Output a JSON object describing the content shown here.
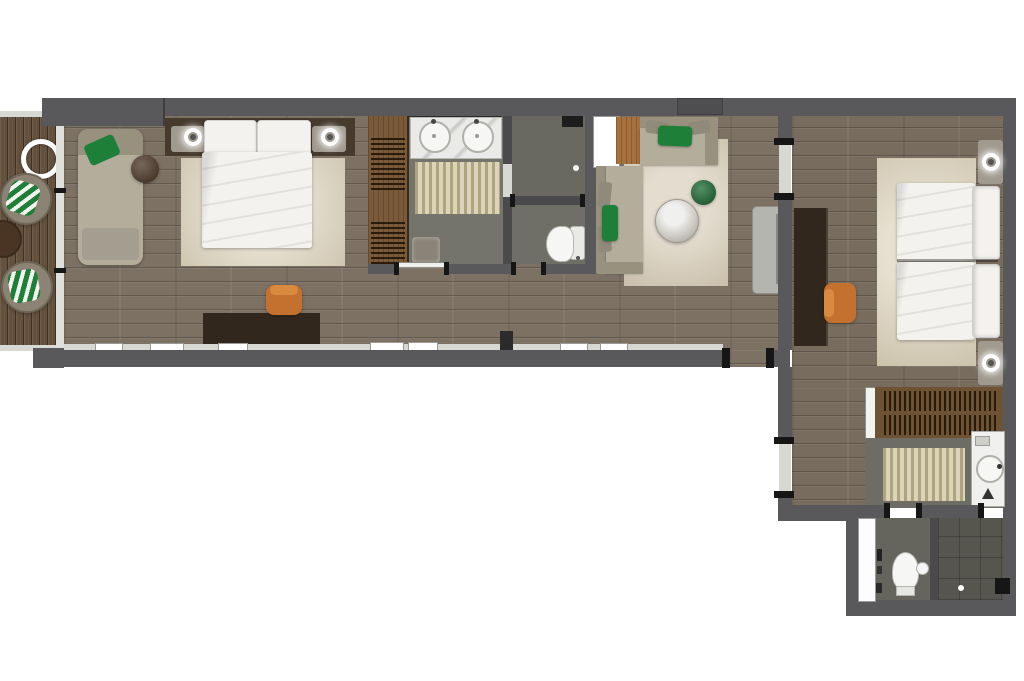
{
  "palette": {
    "wall": "#59595b",
    "wallInner": "#4a4a4c",
    "wallColumn": "#4e4e50",
    "window": "#e0e0da",
    "doorFill": "#d8d8d2",
    "jamb": "#161616",
    "woodMain": "#7d7164",
    "woodRight": "#786c5f",
    "deck": "#64513e",
    "tile": "#74746c",
    "tileShower": "#69695f",
    "tileWC": "#6f6f67",
    "tileBath2": "#6d6d65",
    "tileWC2": "#65655e",
    "tileShower2": "#56564f",
    "rugMaster": "#dcd2bc",
    "rugLiving": "#d5cab5",
    "rugBed2": "#d9cfb7",
    "bathMat": "#ccc29e",
    "bedWhite": "#f3f2ef",
    "sofa": "#b4ad9c",
    "sofaBack": "#98917e",
    "cushionGray": "#8f8a7a",
    "accentGreen": "#1e8038",
    "poufGreen": "#1a6a33",
    "desk": "#32271c",
    "drawer": "#15100b",
    "chairOrange": "#c4702e",
    "wardrobeWood": "#7a5a39",
    "closetWood": "#6d5233",
    "marble": "#eaeae8",
    "tableStone": "#c2bfb8",
    "console": "#b5b5b0",
    "nightstand": "#a09a8e",
    "headboard": "#463a2d",
    "cabinetWood": "#a6713c",
    "fixtureWhite": "#f6f6f4",
    "loungeChair": "#8d8374",
    "sideTableWood": "#4a3524",
    "stool": "#8a8478",
    "throw": "#a49e91",
    "niche": "#ffffff",
    "shaft": "#fdfdfd",
    "sill": "#d8d8d3",
    "showerMat": "#1d1d1d"
  },
  "inventory": {
    "balcony": [
      "wood-deck",
      "lounge-chair",
      "lounge-chair",
      "round-side-table",
      "ring-light"
    ],
    "master_bedroom": [
      "double-bed",
      "pillows",
      "nightstand-left",
      "nightstand-right",
      "bedside-lamp",
      "bedside-lamp",
      "area-rug",
      "chaise-lounge",
      "green-cushion",
      "round-side-table",
      "desk",
      "desk-chair"
    ],
    "master_bathroom": [
      "double-vanity",
      "washbasin",
      "washbasin",
      "wardrobe",
      "bath-mat",
      "stool",
      "walk-in-shower",
      "toilet"
    ],
    "living_area": [
      "corner-sofa",
      "green-cushions",
      "round-coffee-table",
      "green-pouf",
      "area-rug",
      "wood-cabinet",
      "console",
      "storage-niche"
    ],
    "bedroom_2": [
      "twin-bed",
      "twin-bed",
      "area-rug",
      "nightstand",
      "nightstand",
      "bedside-lamp",
      "bedside-lamp",
      "desk",
      "desk-chair"
    ],
    "entry_hall_2": [
      "open-closet",
      "sliding-door"
    ],
    "bathroom_2": [
      "vanity",
      "washbasin",
      "bath-mat",
      "toilet",
      "hand-basin",
      "walk-in-shower",
      "floor-drain",
      "service-shaft"
    ]
  }
}
